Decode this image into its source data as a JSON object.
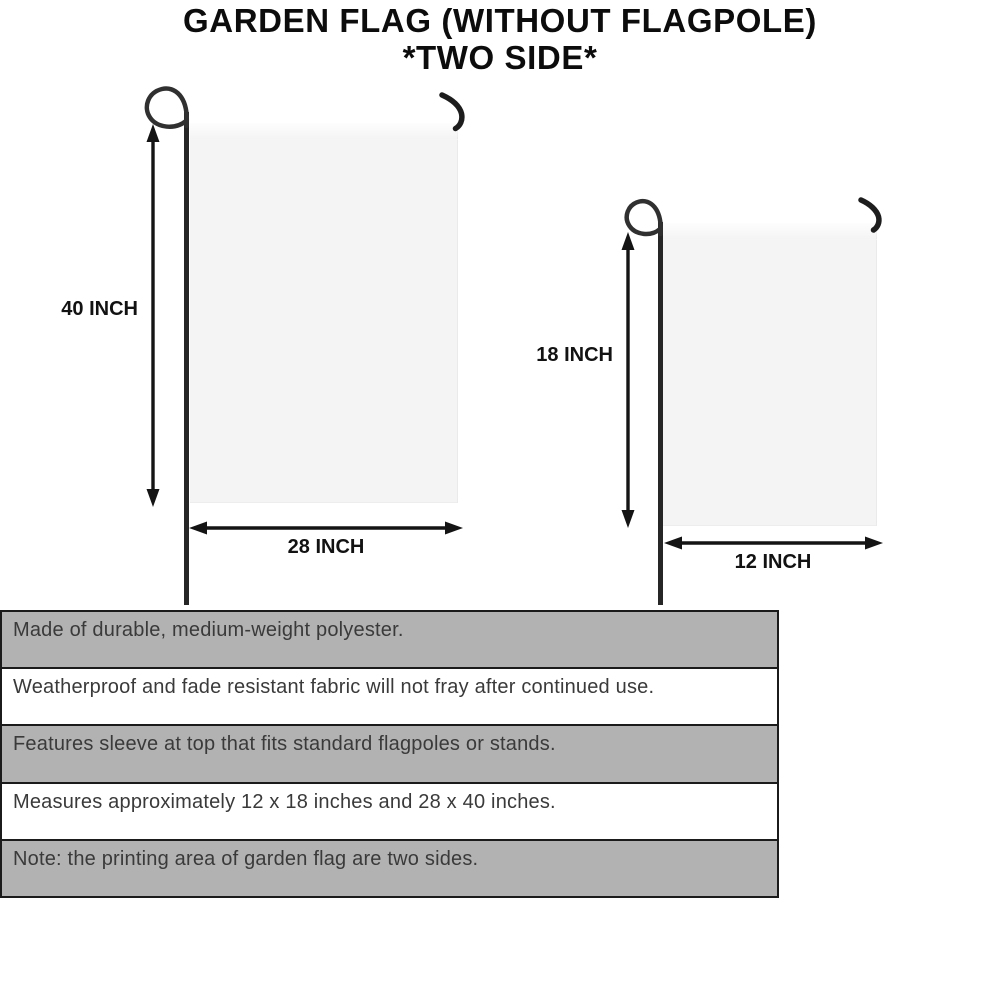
{
  "title": {
    "line1": "GARDEN FLAG (WITHOUT FLAGPOLE)",
    "line2": "*TWO SIDE*"
  },
  "diagram": {
    "large_flag": {
      "height_label": "40 INCH",
      "width_label": "28 INCH"
    },
    "small_flag": {
      "height_label": "18 INCH",
      "width_label": "12 INCH"
    }
  },
  "specs": {
    "rows": [
      {
        "text": "Made of durable, medium-weight polyester."
      },
      {
        "text": "Weatherproof and fade resistant fabric will not fray after continued use."
      },
      {
        "text": "Features sleeve at top that fits standard flagpoles or stands."
      },
      {
        "text": "Measures approximately 12 x 18 inches and 28 x 40 inches."
      },
      {
        "text": "Note: the printing area of garden flag are two sides."
      }
    ]
  },
  "colors": {
    "bar_gray": "#b2b2b2",
    "line_black": "#1a1a1a",
    "flag_fill": "#f4f4f4",
    "text_dark": "#3a3a3a"
  }
}
